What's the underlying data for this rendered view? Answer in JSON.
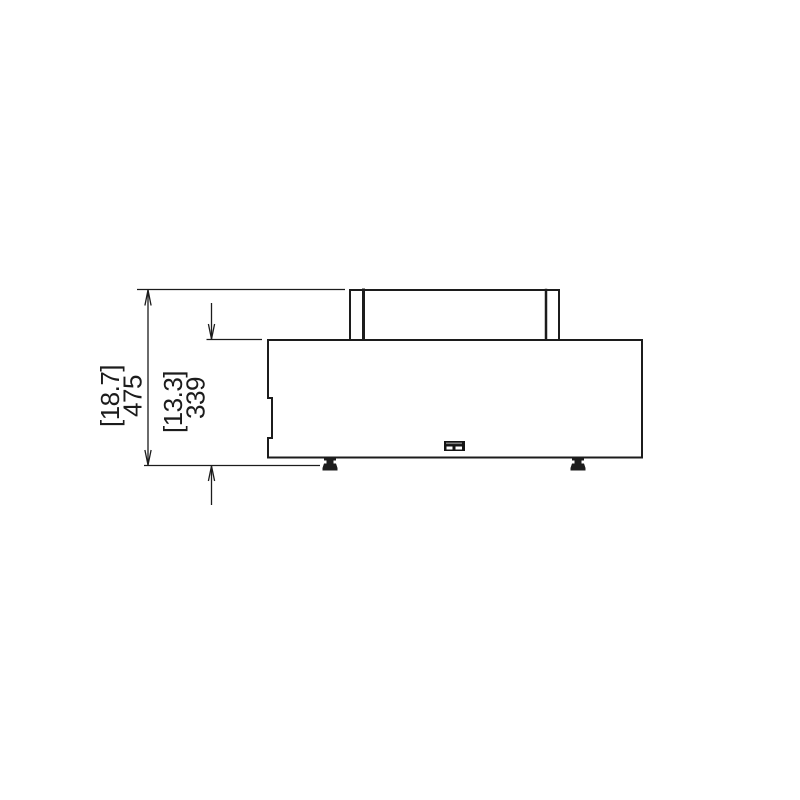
{
  "drawing": {
    "type": "technical-elevation-drawing",
    "background_color": "#ffffff",
    "line_color": "#1c1c1c",
    "dimensions": [
      {
        "name": "overall-height",
        "inches_label": "[18.7]",
        "mm_label": "475"
      },
      {
        "name": "body-height",
        "inches_label": "[13.3]",
        "mm_label": "339"
      }
    ]
  }
}
